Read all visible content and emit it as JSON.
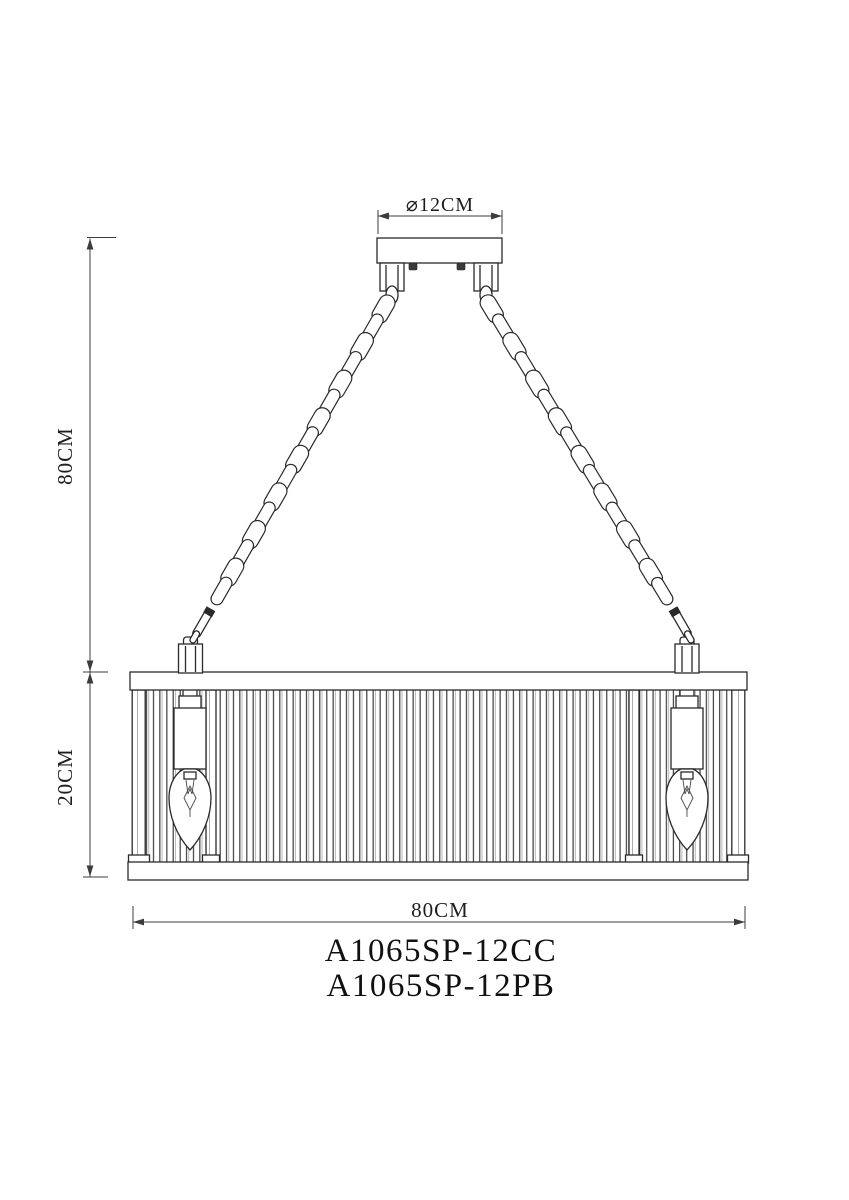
{
  "labels": {
    "canopy_diameter": "⌀12CM",
    "suspension_height": "80CM",
    "shade_height": "20CM",
    "shade_width": "80CM"
  },
  "models": [
    "A1065SP-12CC",
    "A1065SP-12PB"
  ],
  "colors": {
    "line": "#2a2a2a",
    "dimension": "#3c3c3c",
    "background": "#ffffff"
  }
}
